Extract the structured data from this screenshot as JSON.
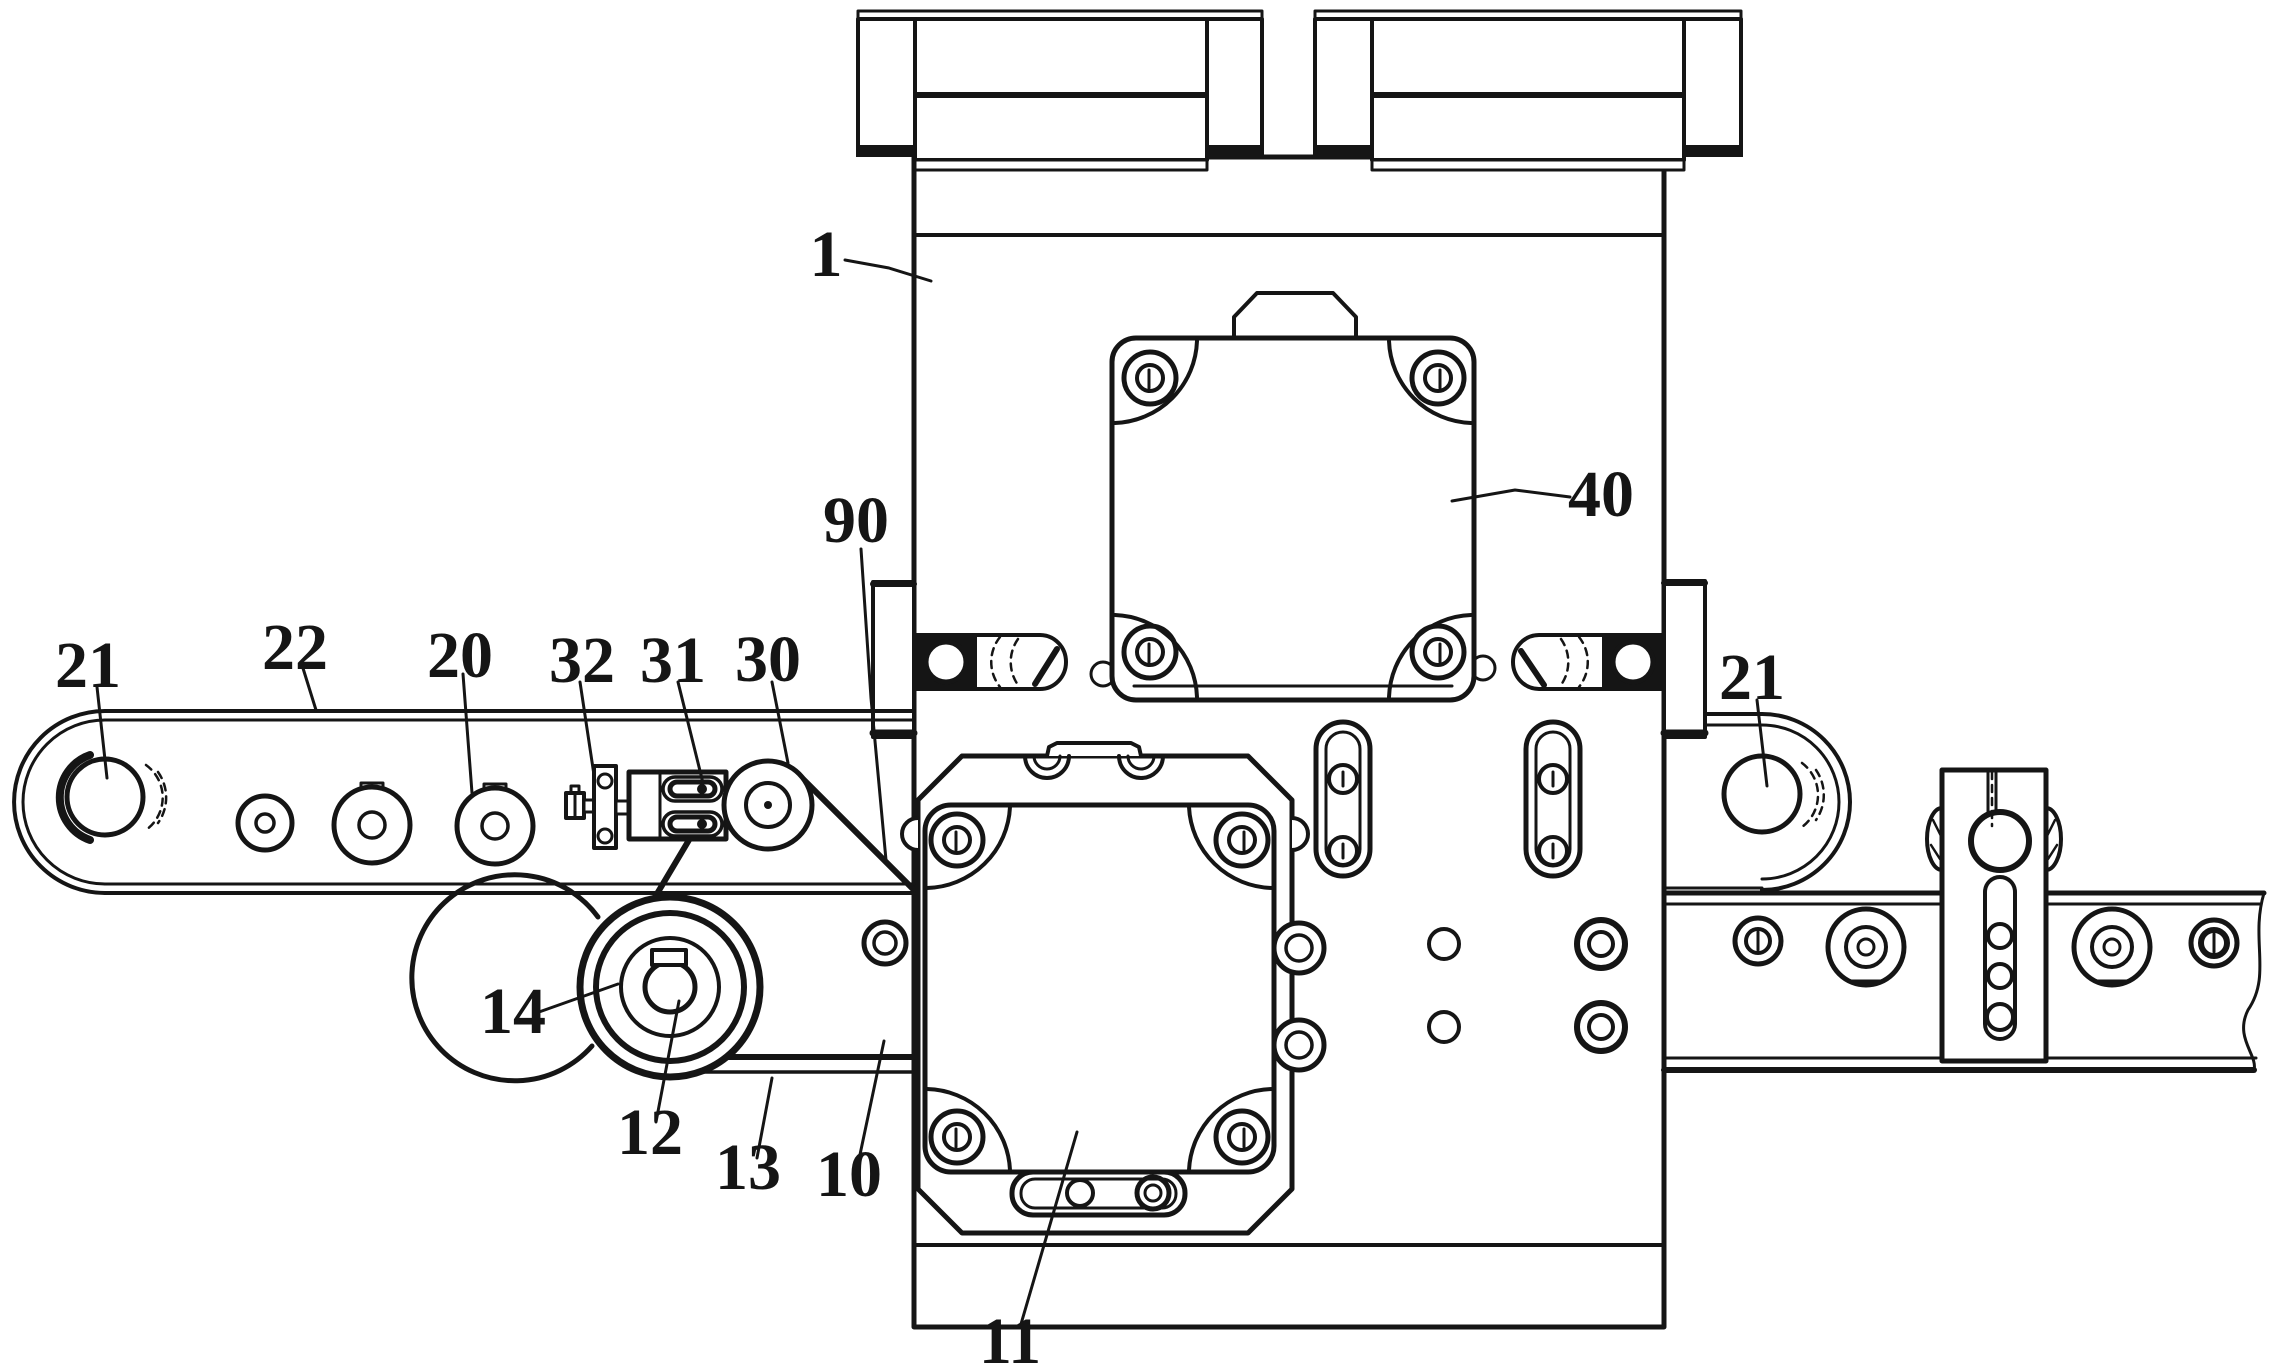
{
  "figure": {
    "kind": "patent-technical-drawing",
    "colors": {
      "background": "#ffffff",
      "ink": "#151515"
    }
  },
  "labels": [
    {
      "text": "1"
    },
    {
      "text": "90"
    },
    {
      "text": "21"
    },
    {
      "text": "22"
    },
    {
      "text": "20"
    },
    {
      "text": "32"
    },
    {
      "text": "31"
    },
    {
      "text": "30"
    },
    {
      "text": "40"
    },
    {
      "text": "21"
    },
    {
      "text": "14"
    },
    {
      "text": "12"
    },
    {
      "text": "13"
    },
    {
      "text": "10"
    },
    {
      "text": "11"
    }
  ]
}
